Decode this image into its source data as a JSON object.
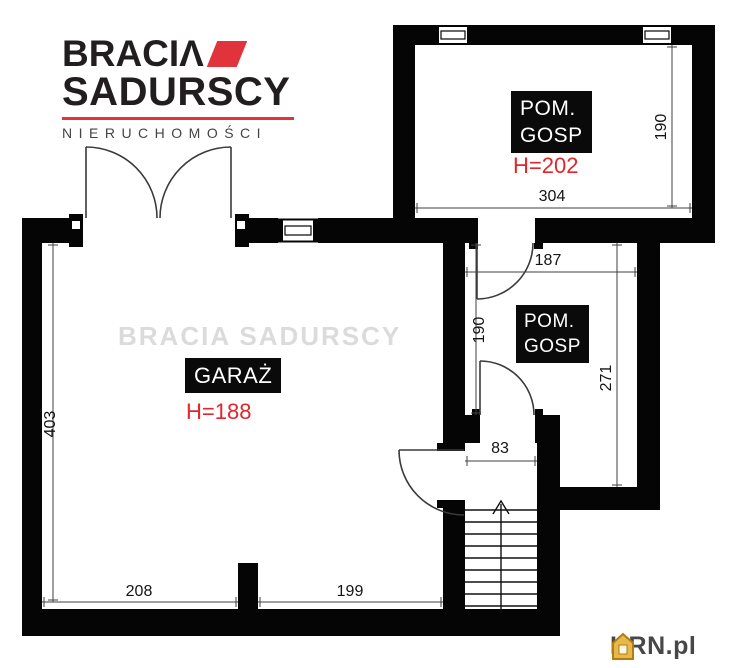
{
  "brand": {
    "name_top": "BRACIΛ",
    "name_bottom": "SADURSCY",
    "tagline": "NIERUCHOMOŚCI"
  },
  "watermark_text": "BRACIA SADURSCY",
  "plan": {
    "rooms": {
      "garage": {
        "label": "GARAŻ",
        "ceiling_height": "H=188"
      },
      "utility_top": {
        "label_line1": "POM.",
        "label_line2": "GOSP",
        "ceiling_height": "H=202"
      },
      "utility_middle": {
        "label_line1": "POM.",
        "label_line2": "GOSP"
      }
    },
    "dimensions": {
      "garage_depth": "403",
      "garage_width_left": "208",
      "garage_width_right": "199",
      "utility_top_width": "304",
      "utility_top_depth": "190",
      "utility_middle_width": "187",
      "utility_middle_depth_left": "190",
      "utility_middle_depth_right": "271",
      "hall_width": "83"
    }
  },
  "footer": {
    "brand": "KRN.pl"
  },
  "colors": {
    "accent_red": "#e0333c",
    "wall_black": "#050505",
    "watermark_gray": "#bdbdbd",
    "footer_gold": "#dfa32b"
  }
}
